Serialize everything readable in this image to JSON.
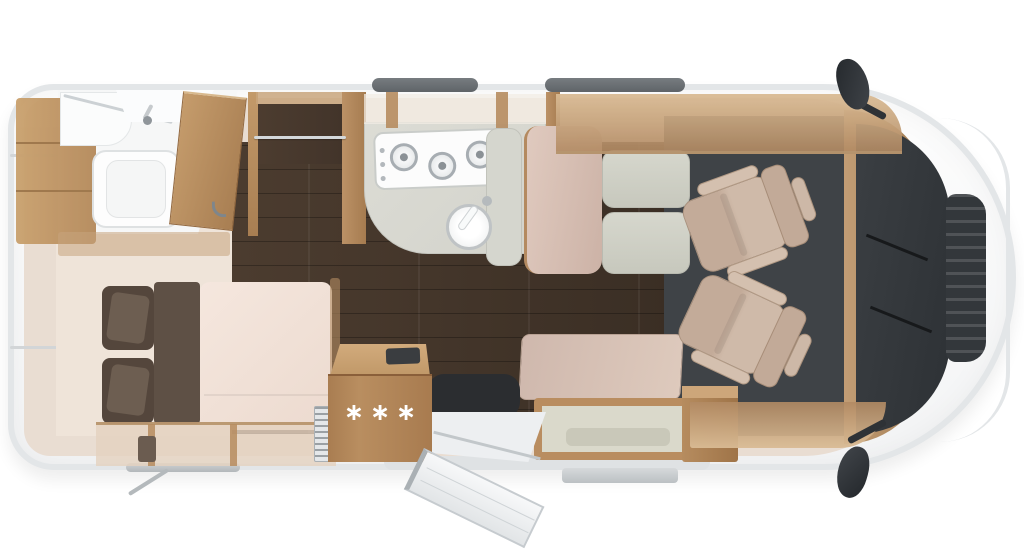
{
  "fridge": {
    "stars_label": "∗∗∗"
  },
  "colors": {
    "body_outline": "#e3e6e8",
    "interior_base": "#e9ddd2",
    "cab_floor": "#3f4347"
  }
}
